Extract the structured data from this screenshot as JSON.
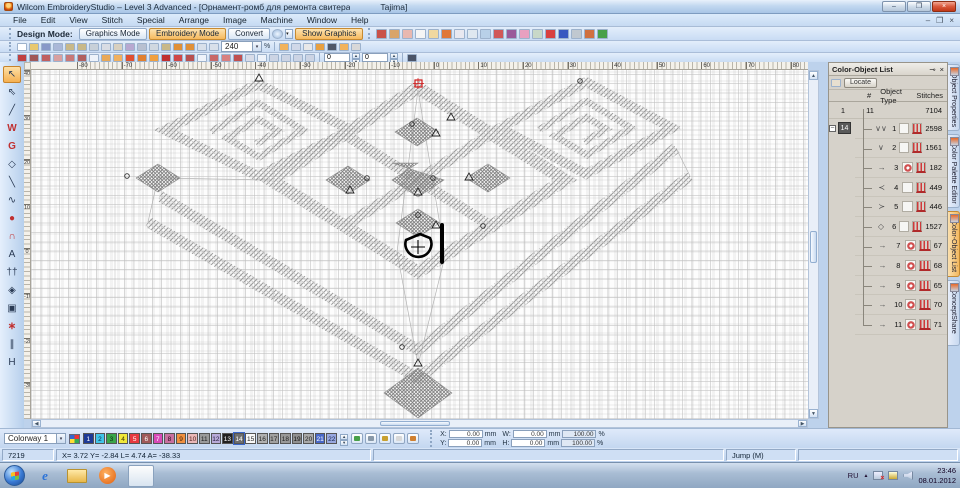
{
  "window": {
    "title": "Wilcom EmbroideryStudio – Level 3 Advanced - [Орнамент-ромб для ремонта свитера",
    "machine": "Tajima]",
    "controls": {
      "minimize": "–",
      "restore": "❐",
      "close": "×"
    }
  },
  "menu": {
    "items": [
      "File",
      "Edit",
      "View",
      "Stitch",
      "Special",
      "Arrange",
      "Image",
      "Machine",
      "Window",
      "Help"
    ],
    "doc_controls": [
      "–",
      "❐",
      "×"
    ]
  },
  "mode_bar": {
    "label": "Design Mode:",
    "graphics_btn": "Graphics Mode",
    "embroidery_btn": "Embroidery Mode",
    "convert_btn": "Convert",
    "show_graphics_btn": "Show Graphics"
  },
  "view_icons": [
    {
      "name": "show-stitches-icon",
      "c": "#c9524a"
    },
    {
      "name": "show-outlines-icon",
      "c": "#d8a46a"
    },
    {
      "name": "show-appliique-icon",
      "c": "#e8b8b0"
    },
    {
      "name": "show-shapes-icon",
      "c": "#f5f5f5"
    },
    {
      "name": "pointer-corner-icon",
      "c": "#f0d8a0"
    },
    {
      "name": "show-needle-points-icon",
      "c": "#e07838"
    },
    {
      "name": "show-grid-icon",
      "c": "#e8e8f0"
    },
    {
      "name": "grid-settings-icon",
      "c": "#dfe8f0"
    },
    {
      "name": "show-picture-icon",
      "c": "#b8d0e8"
    },
    {
      "name": "show-beads-icon",
      "c": "#d05858"
    },
    {
      "name": "show-dice-icon",
      "c": "#9a5a9a"
    },
    {
      "name": "show-flower-icon",
      "c": "#e8a0c0"
    },
    {
      "name": "show-functions-icon",
      "c": "#c8d8c8"
    },
    {
      "name": "color-list-icon",
      "c": "#d84040"
    },
    {
      "name": "palette-icon",
      "c": "#3858c0"
    },
    {
      "name": "machine-icon",
      "c": "#c0c8d0"
    },
    {
      "name": "shapes-icon",
      "c": "#d07040"
    },
    {
      "name": "plant-icon",
      "c": "#48a048"
    }
  ],
  "std_icons": [
    {
      "name": "new-icon",
      "c": "#ffffff"
    },
    {
      "name": "open-icon",
      "c": "#e8c870"
    },
    {
      "name": "save-icon",
      "c": "#8898c8"
    },
    {
      "name": "save-as-icon",
      "c": "#aab8d8"
    },
    {
      "name": "import-icon",
      "c": "#c8b888"
    },
    {
      "name": "export-icon",
      "c": "#c8b888"
    },
    {
      "name": "print-icon",
      "c": "#c8d0d8"
    },
    {
      "name": "print-preview-icon",
      "c": "#d8dce4"
    },
    {
      "name": "scan-icon",
      "c": "#d8d0c0"
    },
    {
      "name": "write-machine-icon",
      "c": "#b8a8d0"
    },
    {
      "name": "cut-icon",
      "c": "#b8c0d0"
    },
    {
      "name": "copy-icon",
      "c": "#d0d8e0"
    },
    {
      "name": "paste-icon",
      "c": "#c8b888"
    },
    {
      "name": "undo-icon",
      "c": "#e09038"
    },
    {
      "name": "redo-icon",
      "c": "#e09038"
    },
    {
      "name": "zoom-box-icon",
      "c": "#d8e0ea"
    },
    {
      "name": "zoom-icon",
      "c": "#d8e0ea"
    }
  ],
  "zoom": {
    "value": "240",
    "percent_label": "%"
  },
  "zoom_extra_icons": [
    {
      "name": "pan-icon",
      "c": "#f2b35c"
    },
    {
      "name": "redraw-icon",
      "c": "#d0d8e8"
    },
    {
      "name": "auto-scroll-icon",
      "c": "#e8e8e8"
    },
    {
      "name": "needle-icon",
      "c": "#e8a040"
    },
    {
      "name": "filter-icon",
      "c": "#505868"
    },
    {
      "name": "operator-icon",
      "c": "#f2b35c"
    },
    {
      "name": "props-icon",
      "c": "#d8d8d8"
    }
  ],
  "stitch_icons": [
    {
      "name": "run-stitch-icon",
      "c": "#c04040"
    },
    {
      "name": "triple-run-icon",
      "c": "#a05858"
    },
    {
      "name": "motif-run-icon",
      "c": "#c06060"
    },
    {
      "name": "backstitch-icon",
      "c": "#d8a0a0"
    },
    {
      "name": "stemstitch-icon",
      "c": "#c87878"
    },
    {
      "name": "sculpture-run-icon",
      "c": "#b06060"
    },
    {
      "name": "sep1",
      "cls": "div"
    },
    {
      "name": "satin-icon",
      "c": "#e8a858"
    },
    {
      "name": "tatami-icon",
      "c": "#f0b060"
    },
    {
      "name": "e-stitch-icon",
      "c": "#e05030"
    },
    {
      "name": "zigzag-icon",
      "c": "#e08030"
    },
    {
      "name": "motif-fill-icon",
      "c": "#f0a040"
    },
    {
      "name": "contour-icon",
      "c": "#c03030"
    },
    {
      "name": "flexi-split-icon",
      "c": "#d04848"
    },
    {
      "name": "fancy-fill-icon",
      "c": "#b85050"
    },
    {
      "name": "sep2",
      "cls": "div"
    },
    {
      "name": "star-fill-icon",
      "c": "#c86868"
    },
    {
      "name": "wave-fill-icon",
      "c": "#d88080"
    },
    {
      "name": "cross-stitch-icon",
      "c": "#c05050"
    },
    {
      "name": "applique-icon",
      "c": "#d8dce8"
    },
    {
      "name": "sep3",
      "cls": "div"
    },
    {
      "name": "mirror-h-icon",
      "c": "#ccd4e4"
    },
    {
      "name": "mirror-v-icon",
      "c": "#ccd4e4"
    },
    {
      "name": "rotate-ccw-icon",
      "c": "#ccd4e4"
    },
    {
      "name": "rotate-cw-icon",
      "c": "#ccd4e4"
    }
  ],
  "stitch_fields": {
    "rotate_value": "0",
    "skew_value": "0"
  },
  "toolbox": [
    {
      "name": "select-tool",
      "glyph": "↖",
      "cls": "active"
    },
    {
      "name": "reshape-tool",
      "glyph": "⇖"
    },
    {
      "name": "knife-tool",
      "glyph": "╱"
    },
    {
      "name": "lettering-w-tool",
      "glyph": "W",
      "cls": "red"
    },
    {
      "name": "monogram-tool",
      "glyph": "G",
      "cls": "red"
    },
    {
      "name": "polygon-tool",
      "glyph": "◇"
    },
    {
      "name": "line-tool",
      "glyph": "╲"
    },
    {
      "name": "open-curve-tool",
      "glyph": "∿"
    },
    {
      "name": "ellipse-tool",
      "glyph": "●",
      "cls": "red"
    },
    {
      "name": "arch-tool",
      "glyph": "∩",
      "cls": "red"
    },
    {
      "name": "lettering-tool",
      "glyph": "A"
    },
    {
      "name": "buddy-tool",
      "glyph": "††"
    },
    {
      "name": "diamond-tool",
      "glyph": "◈"
    },
    {
      "name": "spiral-tool",
      "glyph": "▣"
    },
    {
      "name": "star-tool",
      "glyph": "∗",
      "cls": "red"
    },
    {
      "name": "hatch-tool",
      "glyph": "∥"
    },
    {
      "name": "handle-tool",
      "glyph": "H"
    }
  ],
  "ruler": {
    "h_labels": [
      "-80",
      "-70",
      "-60",
      "-50",
      "-40",
      "-30",
      "-20",
      "-10",
      "0",
      "10",
      "20",
      "30",
      "40",
      "50",
      "60",
      "70",
      "80"
    ],
    "v_labels": [
      "40",
      "30",
      "20",
      "10",
      "0",
      "-10",
      "-20",
      "-30"
    ]
  },
  "panel": {
    "title": "Color-Object List",
    "pin_icon": "⊸",
    "close_icon": "×",
    "locate_btn": "Locate",
    "columns": {
      "c1": "",
      "hash": "#",
      "type": "Object Type",
      "stitches": "Stitches"
    },
    "summary": {
      "count": "1",
      "num": "11",
      "stitches": "7104"
    },
    "group_label": "14",
    "expander": "–",
    "rows": [
      {
        "name": "object-row-1",
        "num": "1",
        "stitches": "2598",
        "glyph": "∨∨",
        "cls": "t-run"
      },
      {
        "name": "object-row-2",
        "num": "2",
        "stitches": "1561",
        "glyph": "∨",
        "cls": "t-run"
      },
      {
        "name": "object-row-3",
        "num": "3",
        "stitches": "182",
        "glyph": "→",
        "cls": "t-fill"
      },
      {
        "name": "object-row-4",
        "num": "4",
        "stitches": "449",
        "glyph": "≺",
        "cls": "t-run"
      },
      {
        "name": "object-row-5",
        "num": "5",
        "stitches": "446",
        "glyph": "≻",
        "cls": "t-run"
      },
      {
        "name": "object-row-6",
        "num": "6",
        "stitches": "1527",
        "glyph": "◇",
        "cls": "t-run"
      },
      {
        "name": "object-row-7",
        "num": "7",
        "stitches": "67",
        "cls": "t-fill",
        "glyph": "→"
      },
      {
        "name": "object-row-8",
        "num": "8",
        "stitches": "68",
        "cls": "t-fill",
        "glyph": "→"
      },
      {
        "name": "object-row-9",
        "num": "9",
        "stitches": "65",
        "cls": "t-fill",
        "glyph": "→"
      },
      {
        "name": "object-row-10",
        "num": "10",
        "stitches": "70",
        "cls": "t-fill",
        "glyph": "→"
      },
      {
        "name": "object-row-11",
        "num": "11",
        "stitches": "71",
        "cls": "t-fill last",
        "glyph": "→"
      }
    ]
  },
  "side_tabs": [
    {
      "name": "tab-object-properties",
      "label": "Object Properties"
    },
    {
      "name": "tab-color-palette-editor",
      "label": "Color Palette Editor"
    },
    {
      "name": "tab-color-object-list",
      "label": "Color-Object List",
      "cls": "active"
    },
    {
      "name": "tab-conceptshare",
      "label": "ConceptShare"
    }
  ],
  "colorway": {
    "value": "Colorway 1",
    "swatches": [
      {
        "n": "1",
        "bg": "#1e3a96",
        "fg": "#ffffff"
      },
      {
        "n": "2",
        "bg": "#40c4e8",
        "fg": "#102840"
      },
      {
        "n": "3",
        "bg": "#3aa54a",
        "fg": "#0a2a10"
      },
      {
        "n": "4",
        "bg": "#f0e83a",
        "fg": "#3a3208"
      },
      {
        "n": "5",
        "bg": "#e63a40",
        "fg": "#ffffff"
      },
      {
        "n": "6",
        "bg": "#a05a5a",
        "fg": "#ffffff"
      },
      {
        "n": "7",
        "bg": "#d84ab8",
        "fg": "#ffffff"
      },
      {
        "n": "8",
        "bg": "#c870a0",
        "fg": "#2a0a1a"
      },
      {
        "n": "9",
        "bg": "#f09040",
        "fg": "#3a1a02"
      },
      {
        "n": "10",
        "bg": "#eab8b8",
        "fg": "#4a1a1a"
      },
      {
        "n": "11",
        "bg": "#9a9a9a",
        "fg": "#1a1a1a"
      },
      {
        "n": "12",
        "bg": "#b8aad8",
        "fg": "#241a3a"
      },
      {
        "n": "13",
        "bg": "#202020",
        "fg": "#ffffff"
      },
      {
        "n": "14",
        "bg": "#6e6e6e",
        "fg": "#ffffff",
        "cls": "selected"
      },
      {
        "n": "15",
        "bg": "#f8f8f8",
        "fg": "#222222"
      },
      {
        "n": "16",
        "bg": "#b0b0b0",
        "fg": "#222222"
      },
      {
        "n": "17",
        "bg": "#a0a0a0",
        "fg": "#222222"
      },
      {
        "n": "18",
        "bg": "#989898",
        "fg": "#222222"
      },
      {
        "n": "19",
        "bg": "#909090",
        "fg": "#111111"
      },
      {
        "n": "20",
        "bg": "#a8a8a8",
        "fg": "#222222"
      },
      {
        "n": "21",
        "bg": "#4868c8",
        "fg": "#ffffff"
      },
      {
        "n": "22",
        "bg": "#98a8e0",
        "fg": "#16244a"
      }
    ],
    "action_icons": [
      {
        "name": "swap-colors-icon",
        "c": "#48a048"
      },
      {
        "name": "remove-color-icon",
        "c": "#8898a8"
      },
      {
        "name": "dye-bucket-icon",
        "c": "#c8a030"
      },
      {
        "name": "transparent-icon",
        "c": "#d8d8d8"
      },
      {
        "name": "cabinet-icon",
        "c": "#d08030"
      }
    ]
  },
  "transform": {
    "x_label": "X:",
    "y_label": "Y:",
    "w_label": "W:",
    "h_label": "H:",
    "x": "0.00",
    "y": "0.00",
    "w": "0.00",
    "h": "0.00",
    "w_pct": "100.00",
    "h_pct": "100.00",
    "unit": "mm",
    "pct": "%"
  },
  "status": {
    "stitch_count": "7219",
    "coords": "X= 3.72 Y= -2.84 L=  4.74 A= -38.33",
    "tool_hint": "Jump (M)"
  },
  "taskbar": {
    "items": [
      {
        "name": "taskbar-ie",
        "glyph": "e",
        "cls": "ie"
      },
      {
        "name": "taskbar-explorer",
        "glyph": "",
        "cls": "folder"
      },
      {
        "name": "taskbar-media-player",
        "glyph": "▶",
        "cls": "media"
      },
      {
        "name": "taskbar-wilcom",
        "glyph": "",
        "cls": "wilcom active"
      }
    ],
    "lang": "RU",
    "tray_caret": "▲",
    "time": "23:46",
    "date": "08.01.2012"
  }
}
